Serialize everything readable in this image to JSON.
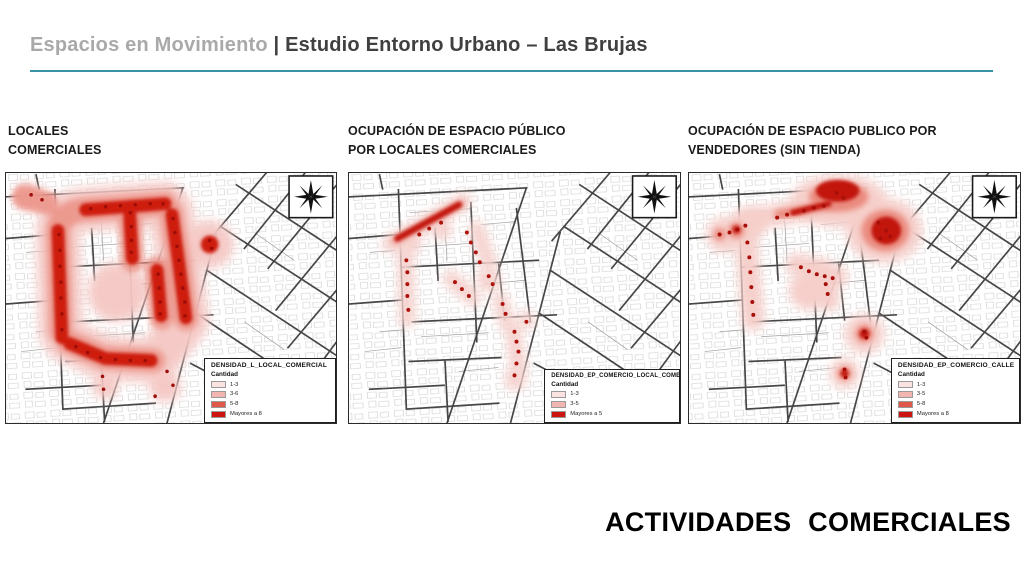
{
  "header": {
    "title_light": "Espacios en Movimiento ",
    "title_dark": "| Estudio Entorno Urbano – Las Brujas",
    "rule_color": "#3a93a3"
  },
  "footer": {
    "caption": "ACTIVIDADES COMERCIALES"
  },
  "heat_ramp": [
    "#f6cfca",
    "#f3b5b0",
    "#e0584a",
    "#cc1410"
  ],
  "maps": [
    {
      "title_line1": "LOCALES",
      "title_line2": "COMERCIALES",
      "compass": "compass-rose-icon",
      "legend": {
        "title": "DENSIDAD_L_LOCAL_COMERCIAL",
        "subtitle": "Cantidad",
        "items": [
          {
            "label": "1-3",
            "color": "#fbe3e1"
          },
          {
            "label": "3-6",
            "color": "#f3b5b0"
          },
          {
            "label": "5-8",
            "color": "#e0584a"
          },
          {
            "label": "Mayores a 8",
            "color": "#cc1410"
          }
        ]
      }
    },
    {
      "title_line1": "OCUPACIÓN DE ESPACIO PÚBLICO",
      "title_line2": "POR LOCALES COMERCIALES",
      "compass": "compass-rose-icon",
      "legend": {
        "title": "DENSIDAD_EP_COMERCIO_LOCAL_COMERCIAL",
        "subtitle": "Cantidad",
        "items": [
          {
            "label": "1-3",
            "color": "#fbe3e1"
          },
          {
            "label": "3-5",
            "color": "#f3b5b0"
          },
          {
            "label": "Mayores a 5",
            "color": "#cc1410"
          }
        ]
      }
    },
    {
      "title_line1": "OCUPACIÓN DE ESPACIO PUBLICO POR",
      "title_line2": "VENDEDORES (SIN TIENDA)",
      "compass": "compass-rose-icon",
      "legend": {
        "title": "DENSIDAD_EP_COMERCIO_CALLE",
        "subtitle": "Cantidad",
        "items": [
          {
            "label": "1-3",
            "color": "#fbe3e1"
          },
          {
            "label": "3-5",
            "color": "#f3b5b0"
          },
          {
            "label": "5-8",
            "color": "#e0584a"
          },
          {
            "label": "Mayores a 8",
            "color": "#cc1410"
          }
        ]
      }
    }
  ]
}
